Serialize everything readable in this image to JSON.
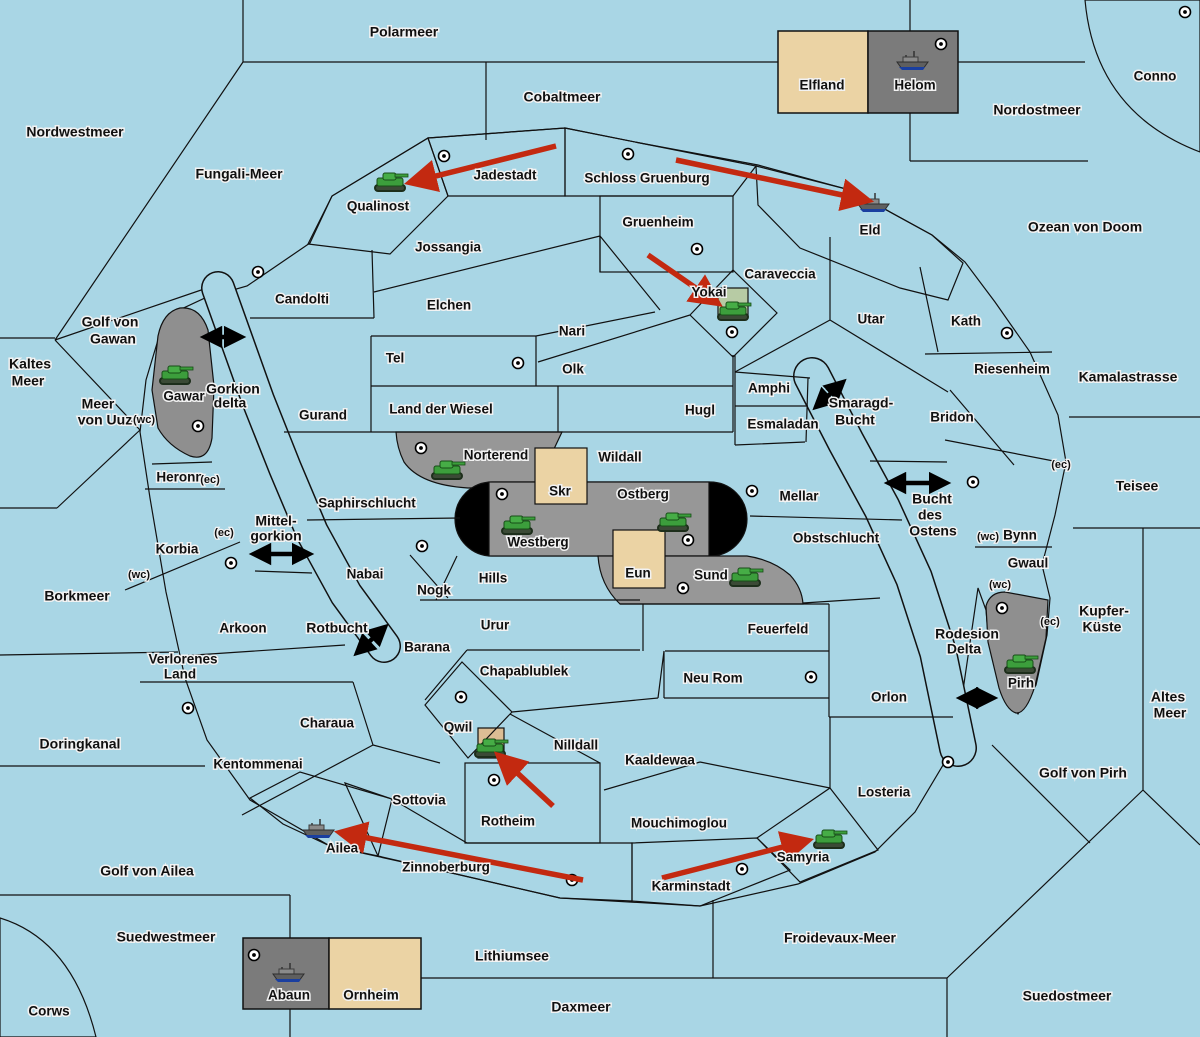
{
  "map": {
    "colors": {
      "ocean": "#A9D6E5",
      "land": "#EBD3A4",
      "green_power": "#A7C69B",
      "red_power": "#C9928E",
      "gray_region": "#979797",
      "gray_box": "#7B7B7B",
      "gray_blob": "#8F8F8F",
      "black_zone": "#000000",
      "order_arrow": "#C32910",
      "link_arrow": "#000000",
      "yokai_square": "#B7CBA4",
      "qwil_square": "#DCBD94"
    },
    "labels": [
      {
        "text": "Polarmeer",
        "x": 404,
        "y": 33,
        "kind": "sea"
      },
      {
        "text": "Cobaltmeer",
        "x": 562,
        "y": 98,
        "kind": "sea"
      },
      {
        "text": "Nordostmeer",
        "x": 1037,
        "y": 111,
        "kind": "sea"
      },
      {
        "text": "Nordwestmeer",
        "x": 75,
        "y": 133,
        "kind": "sea"
      },
      {
        "text": "Fungali-Meer",
        "x": 239,
        "y": 175,
        "kind": "sea"
      },
      {
        "text": "Ozean von Doom",
        "x": 1085,
        "y": 228,
        "kind": "sea"
      },
      {
        "text": "Golf von",
        "x": 110,
        "y": 323,
        "kind": "sea"
      },
      {
        "text": "Gawan",
        "x": 113,
        "y": 340,
        "kind": "sea"
      },
      {
        "text": "Kaltes",
        "x": 30,
        "y": 365,
        "kind": "sea"
      },
      {
        "text": "Meer",
        "x": 28,
        "y": 382,
        "kind": "sea"
      },
      {
        "text": "Kamalastrasse",
        "x": 1128,
        "y": 378,
        "kind": "sea"
      },
      {
        "text": "Meer",
        "x": 98,
        "y": 405,
        "kind": "sea"
      },
      {
        "text": "von Uuz",
        "x": 105,
        "y": 421,
        "kind": "sea"
      },
      {
        "text": "Gorkion",
        "x": 233,
        "y": 390,
        "kind": "sea"
      },
      {
        "text": "delta",
        "x": 230,
        "y": 404,
        "kind": "sea"
      },
      {
        "text": "Smaragd-",
        "x": 861,
        "y": 404,
        "kind": "sea"
      },
      {
        "text": "Bucht",
        "x": 855,
        "y": 421,
        "kind": "sea"
      },
      {
        "text": "Teisee",
        "x": 1137,
        "y": 487,
        "kind": "sea"
      },
      {
        "text": "Mittel-",
        "x": 276,
        "y": 522,
        "kind": "sea"
      },
      {
        "text": "gorkion",
        "x": 276,
        "y": 537,
        "kind": "sea"
      },
      {
        "text": "Bucht",
        "x": 932,
        "y": 500,
        "kind": "sea"
      },
      {
        "text": "des",
        "x": 930,
        "y": 516,
        "kind": "sea"
      },
      {
        "text": "Ostens",
        "x": 933,
        "y": 532,
        "kind": "sea"
      },
      {
        "text": "Borkmeer",
        "x": 77,
        "y": 597,
        "kind": "sea"
      },
      {
        "text": "Kupfer-",
        "x": 1104,
        "y": 612,
        "kind": "sea"
      },
      {
        "text": "Küste",
        "x": 1102,
        "y": 628,
        "kind": "sea"
      },
      {
        "text": "Rotbucht",
        "x": 337,
        "y": 629,
        "kind": "sea"
      },
      {
        "text": "Rodesion",
        "x": 967,
        "y": 635,
        "kind": "sea"
      },
      {
        "text": "Delta",
        "x": 964,
        "y": 650,
        "kind": "sea"
      },
      {
        "text": "Altes",
        "x": 1168,
        "y": 698,
        "kind": "sea"
      },
      {
        "text": "Meer",
        "x": 1170,
        "y": 714,
        "kind": "sea"
      },
      {
        "text": "Doringkanal",
        "x": 80,
        "y": 745,
        "kind": "sea"
      },
      {
        "text": "Golf von Pirh",
        "x": 1083,
        "y": 774,
        "kind": "sea"
      },
      {
        "text": "Golf von Ailea",
        "x": 147,
        "y": 872,
        "kind": "sea"
      },
      {
        "text": "Suedwestmeer",
        "x": 166,
        "y": 938,
        "kind": "sea"
      },
      {
        "text": "Froidevaux-Meer",
        "x": 840,
        "y": 939,
        "kind": "sea"
      },
      {
        "text": "Lithiumsee",
        "x": 512,
        "y": 957,
        "kind": "sea"
      },
      {
        "text": "Daxmeer",
        "x": 581,
        "y": 1008,
        "kind": "sea"
      },
      {
        "text": "Suedostmeer",
        "x": 1067,
        "y": 997,
        "kind": "sea"
      },
      {
        "text": "Conno",
        "x": 1155,
        "y": 77,
        "kind": "land"
      },
      {
        "text": "Elfland",
        "x": 822,
        "y": 86,
        "kind": "land"
      },
      {
        "text": "Helom",
        "x": 915,
        "y": 86,
        "kind": "land"
      },
      {
        "text": "Jadestadt",
        "x": 505,
        "y": 176,
        "kind": "land"
      },
      {
        "text": "Schloss Gruenburg",
        "x": 647,
        "y": 179,
        "kind": "land"
      },
      {
        "text": "Qualinost",
        "x": 378,
        "y": 207,
        "kind": "land"
      },
      {
        "text": "Gruenheim",
        "x": 658,
        "y": 223,
        "kind": "land"
      },
      {
        "text": "Eld",
        "x": 870,
        "y": 231,
        "kind": "land"
      },
      {
        "text": "Jossangia",
        "x": 448,
        "y": 248,
        "kind": "land"
      },
      {
        "text": "Caraveccia",
        "x": 780,
        "y": 275,
        "kind": "land"
      },
      {
        "text": "Candolti",
        "x": 302,
        "y": 300,
        "kind": "land"
      },
      {
        "text": "Elchen",
        "x": 449,
        "y": 306,
        "kind": "land"
      },
      {
        "text": "Yokai",
        "x": 709,
        "y": 293,
        "kind": "land"
      },
      {
        "text": "Utar",
        "x": 871,
        "y": 320,
        "kind": "land"
      },
      {
        "text": "Kath",
        "x": 966,
        "y": 322,
        "kind": "land"
      },
      {
        "text": "Nari",
        "x": 572,
        "y": 332,
        "kind": "land"
      },
      {
        "text": "Tel",
        "x": 395,
        "y": 359,
        "kind": "land"
      },
      {
        "text": "Olk",
        "x": 573,
        "y": 370,
        "kind": "land"
      },
      {
        "text": "Riesenheim",
        "x": 1012,
        "y": 370,
        "kind": "land"
      },
      {
        "text": "Gawar",
        "x": 184,
        "y": 397,
        "kind": "land"
      },
      {
        "text": "Amphi",
        "x": 769,
        "y": 389,
        "kind": "land"
      },
      {
        "text": "Gurand",
        "x": 323,
        "y": 416,
        "kind": "land"
      },
      {
        "text": "Land der Wiesel",
        "x": 441,
        "y": 410,
        "kind": "land"
      },
      {
        "text": "Hugl",
        "x": 700,
        "y": 411,
        "kind": "land"
      },
      {
        "text": "Esmaladan",
        "x": 783,
        "y": 425,
        "kind": "land"
      },
      {
        "text": "Bridon",
        "x": 952,
        "y": 418,
        "kind": "land"
      },
      {
        "text": "Norterend",
        "x": 496,
        "y": 456,
        "kind": "land"
      },
      {
        "text": "Wildall",
        "x": 620,
        "y": 458,
        "kind": "land"
      },
      {
        "text": "Heronn",
        "x": 180,
        "y": 478,
        "kind": "land"
      },
      {
        "text": "Skr",
        "x": 560,
        "y": 492,
        "kind": "land"
      },
      {
        "text": "Ostberg",
        "x": 643,
        "y": 495,
        "kind": "land"
      },
      {
        "text": "Mellar",
        "x": 799,
        "y": 497,
        "kind": "land"
      },
      {
        "text": "Saphirschlucht",
        "x": 367,
        "y": 504,
        "kind": "land"
      },
      {
        "text": "Westberg",
        "x": 538,
        "y": 543,
        "kind": "land"
      },
      {
        "text": "Korbia",
        "x": 177,
        "y": 550,
        "kind": "land"
      },
      {
        "text": "Obstschlucht",
        "x": 836,
        "y": 539,
        "kind": "land"
      },
      {
        "text": "Bynn",
        "x": 1020,
        "y": 536,
        "kind": "land"
      },
      {
        "text": "Gwaul",
        "x": 1028,
        "y": 564,
        "kind": "land"
      },
      {
        "text": "Nabai",
        "x": 365,
        "y": 575,
        "kind": "land"
      },
      {
        "text": "Hills",
        "x": 493,
        "y": 579,
        "kind": "land"
      },
      {
        "text": "Eun",
        "x": 638,
        "y": 574,
        "kind": "land"
      },
      {
        "text": "Sund",
        "x": 711,
        "y": 576,
        "kind": "land"
      },
      {
        "text": "Nogk",
        "x": 434,
        "y": 591,
        "kind": "land"
      },
      {
        "text": "Urur",
        "x": 495,
        "y": 626,
        "kind": "land"
      },
      {
        "text": "Arkoon",
        "x": 243,
        "y": 629,
        "kind": "land"
      },
      {
        "text": "Feuerfeld",
        "x": 778,
        "y": 630,
        "kind": "land"
      },
      {
        "text": "Barana",
        "x": 427,
        "y": 648,
        "kind": "land"
      },
      {
        "text": "Verlorenes",
        "x": 183,
        "y": 660,
        "kind": "land"
      },
      {
        "text": "Land",
        "x": 180,
        "y": 675,
        "kind": "land"
      },
      {
        "text": "Chapablublek",
        "x": 524,
        "y": 672,
        "kind": "land"
      },
      {
        "text": "Neu Rom",
        "x": 713,
        "y": 679,
        "kind": "land"
      },
      {
        "text": "Pirh",
        "x": 1021,
        "y": 684,
        "kind": "land"
      },
      {
        "text": "Orlon",
        "x": 889,
        "y": 698,
        "kind": "land"
      },
      {
        "text": "Charaua",
        "x": 327,
        "y": 724,
        "kind": "land"
      },
      {
        "text": "Qwil",
        "x": 458,
        "y": 728,
        "kind": "land"
      },
      {
        "text": "Nilldall",
        "x": 576,
        "y": 746,
        "kind": "land"
      },
      {
        "text": "Kaaldewaa",
        "x": 660,
        "y": 761,
        "kind": "land"
      },
      {
        "text": "Kentommenai",
        "x": 258,
        "y": 765,
        "kind": "land"
      },
      {
        "text": "Losteria",
        "x": 884,
        "y": 793,
        "kind": "land"
      },
      {
        "text": "Sottovia",
        "x": 419,
        "y": 801,
        "kind": "land"
      },
      {
        "text": "Rotheim",
        "x": 508,
        "y": 822,
        "kind": "land"
      },
      {
        "text": "Mouchimoglou",
        "x": 679,
        "y": 824,
        "kind": "land"
      },
      {
        "text": "Ailea",
        "x": 342,
        "y": 849,
        "kind": "land"
      },
      {
        "text": "Samyria",
        "x": 803,
        "y": 858,
        "kind": "land"
      },
      {
        "text": "Zinnoberburg",
        "x": 446,
        "y": 868,
        "kind": "land"
      },
      {
        "text": "Karminstadt",
        "x": 691,
        "y": 887,
        "kind": "land"
      },
      {
        "text": "Abaun",
        "x": 289,
        "y": 996,
        "kind": "land"
      },
      {
        "text": "Ornheim",
        "x": 371,
        "y": 996,
        "kind": "land"
      },
      {
        "text": "Corws",
        "x": 49,
        "y": 1012,
        "kind": "land"
      },
      {
        "text": "(wc)",
        "x": 144,
        "y": 420,
        "kind": "coast"
      },
      {
        "text": "(ec)",
        "x": 210,
        "y": 480,
        "kind": "coast"
      },
      {
        "text": "(ec)",
        "x": 224,
        "y": 533,
        "kind": "coast"
      },
      {
        "text": "(wc)",
        "x": 139,
        "y": 575,
        "kind": "coast"
      },
      {
        "text": "(ec)",
        "x": 1061,
        "y": 465,
        "kind": "coast"
      },
      {
        "text": "(wc)",
        "x": 988,
        "y": 537,
        "kind": "coast"
      },
      {
        "text": "(wc)",
        "x": 1000,
        "y": 585,
        "kind": "coast"
      },
      {
        "text": "(ec)",
        "x": 1050,
        "y": 622,
        "kind": "coast"
      }
    ],
    "supply_centers": [
      {
        "x": 444,
        "y": 156
      },
      {
        "x": 628,
        "y": 154
      },
      {
        "x": 697,
        "y": 249
      },
      {
        "x": 732,
        "y": 332
      },
      {
        "x": 258,
        "y": 272
      },
      {
        "x": 518,
        "y": 363
      },
      {
        "x": 1007,
        "y": 333
      },
      {
        "x": 1185,
        "y": 12
      },
      {
        "x": 941,
        "y": 44
      },
      {
        "x": 421,
        "y": 448
      },
      {
        "x": 502,
        "y": 494
      },
      {
        "x": 688,
        "y": 540
      },
      {
        "x": 752,
        "y": 491
      },
      {
        "x": 683,
        "y": 588
      },
      {
        "x": 422,
        "y": 546
      },
      {
        "x": 231,
        "y": 563
      },
      {
        "x": 198,
        "y": 426
      },
      {
        "x": 461,
        "y": 697
      },
      {
        "x": 494,
        "y": 780
      },
      {
        "x": 188,
        "y": 708
      },
      {
        "x": 572,
        "y": 880
      },
      {
        "x": 742,
        "y": 869
      },
      {
        "x": 948,
        "y": 762
      },
      {
        "x": 973,
        "y": 482
      },
      {
        "x": 1002,
        "y": 608
      },
      {
        "x": 254,
        "y": 955
      },
      {
        "x": 811,
        "y": 677
      }
    ],
    "units": [
      {
        "type": "army",
        "province": "Qualinost",
        "x": 390,
        "y": 182
      },
      {
        "type": "army",
        "province": "Yokai",
        "x": 733,
        "y": 311
      },
      {
        "type": "army",
        "province": "Gawar",
        "x": 175,
        "y": 375
      },
      {
        "type": "army",
        "province": "Norterend",
        "x": 447,
        "y": 470
      },
      {
        "type": "army",
        "province": "Westberg",
        "x": 517,
        "y": 525
      },
      {
        "type": "army",
        "province": "Ostberg",
        "x": 673,
        "y": 522
      },
      {
        "type": "army",
        "province": "Sund",
        "x": 745,
        "y": 577
      },
      {
        "type": "army",
        "province": "Pirh",
        "x": 1020,
        "y": 664
      },
      {
        "type": "army",
        "province": "Qwil",
        "x": 490,
        "y": 748
      },
      {
        "type": "army",
        "province": "Samyria",
        "x": 829,
        "y": 839
      },
      {
        "type": "fleet",
        "province": "Helom",
        "x": 912,
        "y": 62
      },
      {
        "type": "fleet",
        "province": "Eld",
        "x": 873,
        "y": 204
      },
      {
        "type": "fleet",
        "province": "Ailea",
        "x": 318,
        "y": 830
      },
      {
        "type": "fleet",
        "province": "Abaun",
        "x": 288,
        "y": 974
      }
    ],
    "move_arrows": [
      {
        "x1": 556,
        "y1": 146,
        "x2": 412,
        "y2": 182
      },
      {
        "x1": 676,
        "y1": 160,
        "x2": 866,
        "y2": 200
      },
      {
        "x1": 648,
        "y1": 255,
        "x2": 716,
        "y2": 302
      },
      {
        "x1": 553,
        "y1": 806,
        "x2": 500,
        "y2": 757
      },
      {
        "x1": 583,
        "y1": 880,
        "x2": 342,
        "y2": 833
      },
      {
        "x1": 662,
        "y1": 878,
        "x2": 806,
        "y2": 841
      }
    ],
    "link_arrows": [
      {
        "x1": 206,
        "y1": 337,
        "x2": 240,
        "y2": 337
      },
      {
        "x1": 255,
        "y1": 554,
        "x2": 308,
        "y2": 554
      },
      {
        "x1": 890,
        "y1": 483,
        "x2": 945,
        "y2": 483
      },
      {
        "x1": 817,
        "y1": 406,
        "x2": 842,
        "y2": 383
      },
      {
        "x1": 358,
        "y1": 652,
        "x2": 384,
        "y2": 628
      },
      {
        "x1": 962,
        "y1": 698,
        "x2": 992,
        "y2": 698
      }
    ]
  }
}
